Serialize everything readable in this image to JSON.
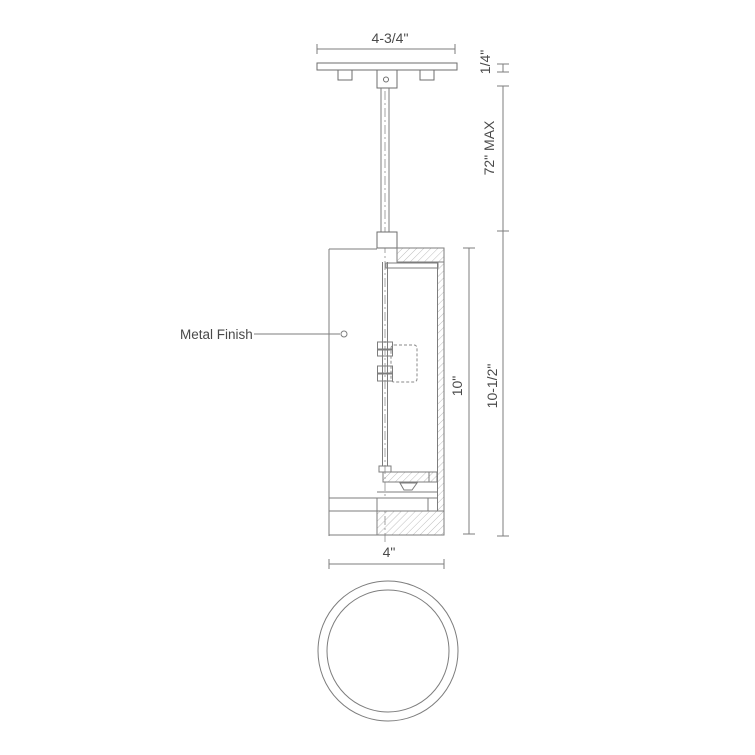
{
  "drawing": {
    "view": "pendant-light-section-and-bottom-view",
    "colors": {
      "background": "#ffffff",
      "line": "#7d7d7d",
      "hatch": "#aeaeae",
      "text": "#4a4a4a"
    },
    "callouts": {
      "metal_finish": "Metal Finish"
    },
    "dimensions": {
      "canopy_width": "4-3/4\"",
      "canopy_thickness": "1/4\"",
      "max_drop": "72\" MAX",
      "body_height": "10\"",
      "overall_fixture_height": "10-1/2\"",
      "body_diameter": "4\""
    }
  }
}
